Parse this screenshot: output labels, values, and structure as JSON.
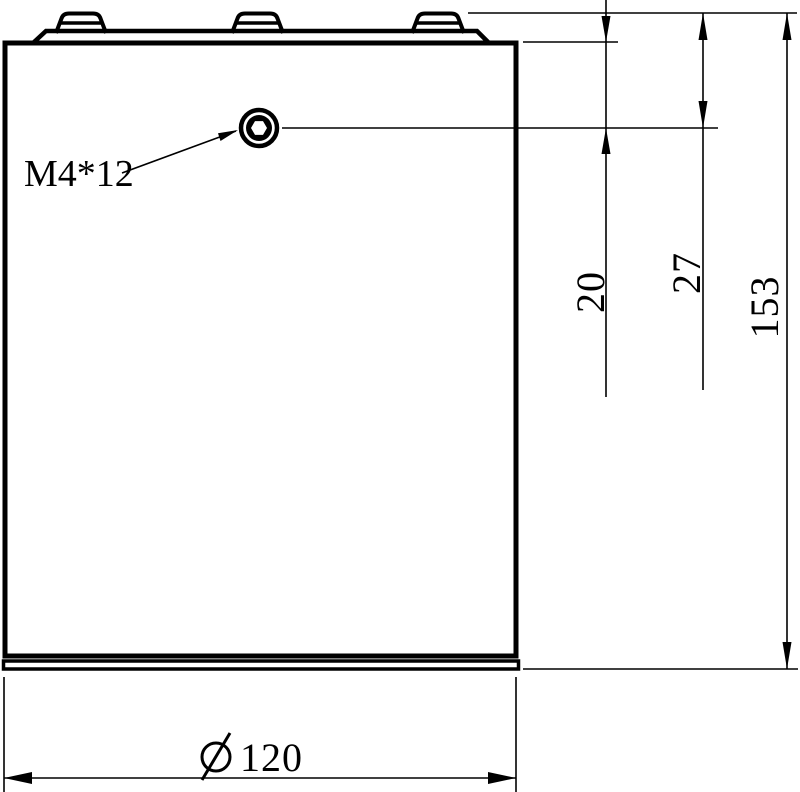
{
  "drawing": {
    "type": "engineering-drawing-side-view",
    "callout": {
      "screw_spec": "M4*12"
    },
    "dimensions": {
      "body_top_to_hole": "20",
      "tab_top_to_hole": "27",
      "overall_height": "153",
      "diameter_value": "120",
      "diameter_symbol": "Ø"
    },
    "colors": {
      "line": "#000000",
      "background": "#ffffff"
    }
  }
}
